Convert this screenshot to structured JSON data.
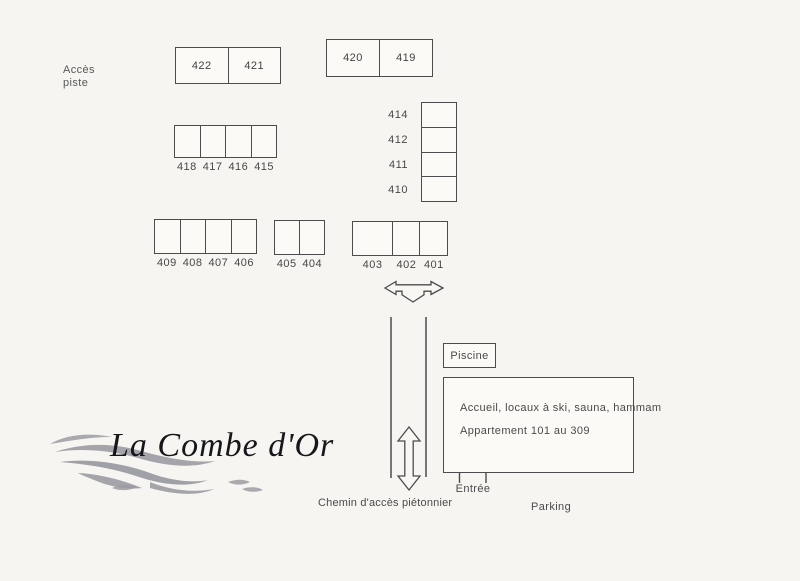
{
  "page": {
    "background": "#f6f5f2",
    "line_color": "#4c4c4c",
    "box_fill": "#fbfaf7",
    "label_color": "#4a4a4a",
    "wave_color": "#9b9ba2",
    "logo_color": "#17171b"
  },
  "labels": {
    "acces_piste": [
      "Accès",
      "piste"
    ],
    "piscine": "Piscine",
    "building_line1": "Accueil, locaux à ski, sauna, hammam",
    "building_line2": "Appartement 101 au 309",
    "entree": "Entrée",
    "parking": "Parking",
    "chemin": "Chemin d'accès piétonnier"
  },
  "logo": {
    "text": "La Combe d'Or"
  },
  "icons": {
    "crossing_arrow": "three-way-outline-arrow (left-right-down)",
    "path_arrow": "double-headed-vertical-outline-arrow"
  },
  "blocks": [
    {
      "name": "block-422-421",
      "type": "inside",
      "x": 175,
      "y": 47,
      "width": 106,
      "height": 37,
      "cells": [
        {
          "label": "422"
        },
        {
          "label": "421"
        }
      ]
    },
    {
      "name": "block-420-419",
      "type": "inside",
      "x": 326,
      "y": 39,
      "width": 107,
      "height": 38,
      "cells": [
        {
          "label": "420"
        },
        {
          "label": "419"
        }
      ]
    },
    {
      "name": "block-418-415",
      "type": "below",
      "x": 174,
      "y": 125,
      "width": 103,
      "height": 33,
      "cells": [
        {
          "label": "418"
        },
        {
          "label": "417"
        },
        {
          "label": "416"
        },
        {
          "label": "415"
        }
      ]
    },
    {
      "name": "block-414-410",
      "type": "column",
      "x": 421,
      "y": 102,
      "width": 36,
      "height": 100,
      "cells": [
        {
          "label": "414"
        },
        {
          "label": "412"
        },
        {
          "label": "411"
        },
        {
          "label": "410"
        }
      ]
    },
    {
      "name": "block-409-406",
      "type": "below",
      "x": 154,
      "y": 219,
      "width": 103,
      "height": 35,
      "cells": [
        {
          "label": "409"
        },
        {
          "label": "408"
        },
        {
          "label": "407"
        },
        {
          "label": "406"
        }
      ]
    },
    {
      "name": "block-405-404",
      "type": "below",
      "x": 274,
      "y": 220,
      "width": 51,
      "height": 35,
      "cells": [
        {
          "label": "405"
        },
        {
          "label": "404"
        }
      ]
    },
    {
      "name": "block-403-401",
      "type": "below",
      "x": 352,
      "y": 221,
      "width": 96,
      "height": 35,
      "cells": [
        {
          "label": "403",
          "flex": 1.5
        },
        {
          "label": "402",
          "flex": 0.97
        },
        {
          "label": "401",
          "flex": 1.03
        }
      ]
    }
  ]
}
